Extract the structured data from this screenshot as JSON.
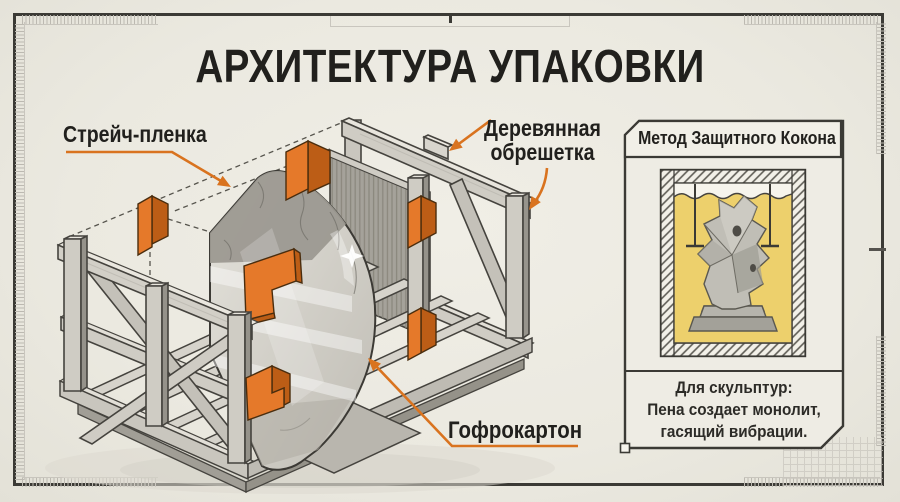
{
  "title": "АРХИТЕКТУРА УПАКОВКИ",
  "callouts": {
    "stretch_film": "Стрейч-пленка",
    "wooden_crate_line1": "Деревянная",
    "wooden_crate_line2": "обрешетка",
    "cardboard": "Гофрокартон"
  },
  "side_panel": {
    "header": "Метод Защитного Кокона",
    "caption": [
      "Для скульптур:",
      "Пена создает монолит,",
      "гасящий вибрации."
    ]
  },
  "colors": {
    "accent_orange": "#D9731F",
    "corner_orange": "#E5792A",
    "foam_yellow": "#EDD06C",
    "paper": "#EDEBE2",
    "ink": "#21201D",
    "outline": "#3B3A35"
  }
}
